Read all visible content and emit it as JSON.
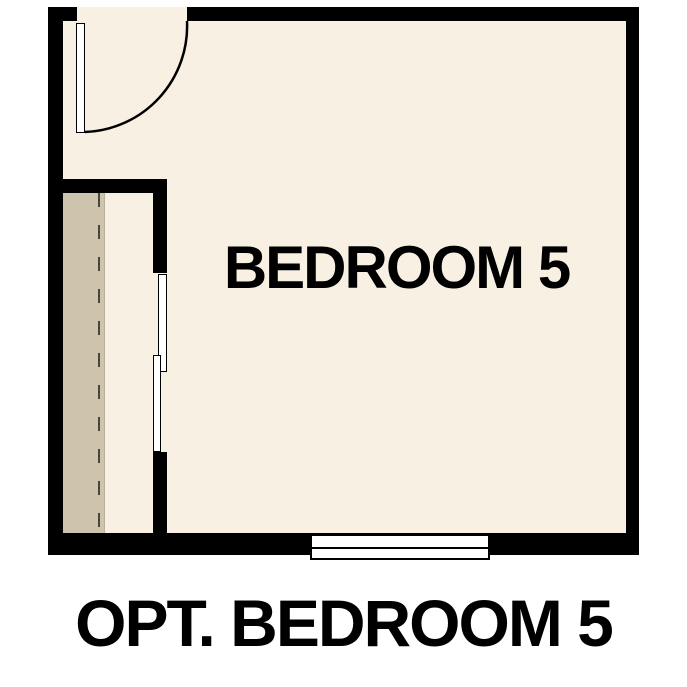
{
  "floor_plan": {
    "room_label": "BEDROOM 5",
    "caption": "OPT. BEDROOM 5",
    "features": {
      "door": "hinged entry door with quarter-circle swing arc, top-left",
      "closet": "left-side closet with rod (dashed line) and bypass sliding doors",
      "window": "double-line window centered in bottom wall"
    },
    "colors": {
      "background": "#ffffff",
      "wall": "#000000",
      "floor": "#f7f0e3",
      "closet_floor": "#cec3ac",
      "rod_dash": "#4a463e",
      "fixture_fill": "#ffffff",
      "text": "#000000"
    }
  }
}
